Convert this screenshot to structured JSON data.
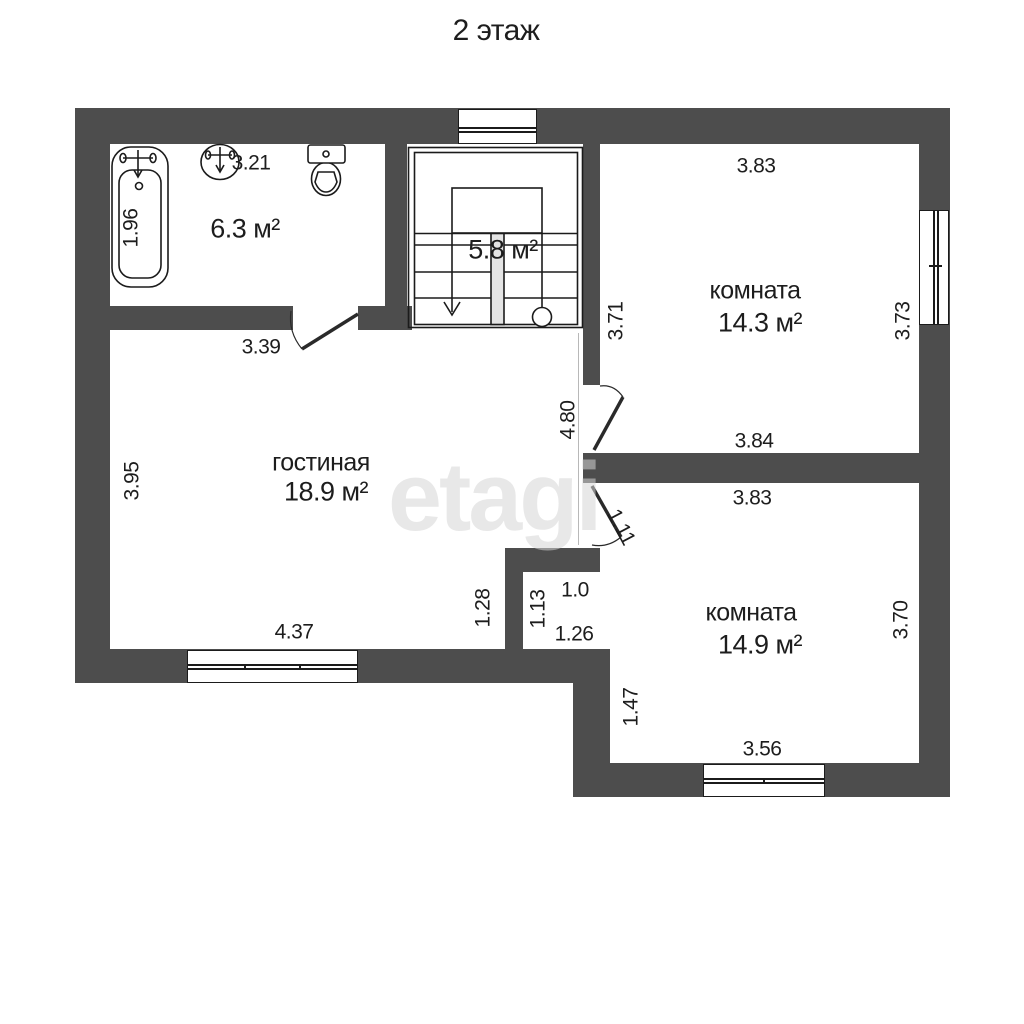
{
  "title": "2 этаж",
  "watermark": "etagi",
  "colors": {
    "wall": "#4d4d4d",
    "line": "#1b1b1b",
    "text": "#1d1d1d",
    "background": "#ffffff"
  },
  "rooms": [
    {
      "id": "bathroom",
      "name": "",
      "area": "6.3 м²",
      "fixtures": [
        "bathtub-icon",
        "sink-icon",
        "toilet-icon"
      ]
    },
    {
      "id": "staircase",
      "name": "",
      "area": "5.8 м²"
    },
    {
      "id": "room-top",
      "name": "комната",
      "area": "14.3 м²"
    },
    {
      "id": "living-room",
      "name": "гостиная",
      "area": "18.9 м²"
    },
    {
      "id": "room-bottom",
      "name": "комната",
      "area": "14.9 м²"
    }
  ],
  "labels": [
    {
      "text": "3.21",
      "x": 251,
      "y": 163,
      "rot": 0,
      "kind": "dimension"
    },
    {
      "text": "1.96",
      "x": 131,
      "y": 228,
      "rot": -90,
      "kind": "dimension"
    },
    {
      "text": "6.3 м²",
      "x": 245,
      "y": 229,
      "rot": 0,
      "kind": "room-area"
    },
    {
      "text": "5.8 м²",
      "x": 503,
      "y": 250,
      "rot": 0,
      "kind": "room-area"
    },
    {
      "text": "3.83",
      "x": 756,
      "y": 166,
      "rot": 0,
      "kind": "dimension"
    },
    {
      "text": "комната",
      "x": 755,
      "y": 291,
      "rot": 0,
      "kind": "room-name"
    },
    {
      "text": "14.3 м²",
      "x": 760,
      "y": 323,
      "rot": 0,
      "kind": "room-area"
    },
    {
      "text": "3.71",
      "x": 616,
      "y": 321,
      "rot": -90,
      "kind": "dimension"
    },
    {
      "text": "3.73",
      "x": 903,
      "y": 321,
      "rot": -90,
      "kind": "dimension"
    },
    {
      "text": "3.84",
      "x": 754,
      "y": 441,
      "rot": 0,
      "kind": "dimension"
    },
    {
      "text": "3.39",
      "x": 261,
      "y": 347,
      "rot": 0,
      "kind": "dimension"
    },
    {
      "text": "4.80",
      "x": 568,
      "y": 420,
      "rot": -90,
      "kind": "dimension"
    },
    {
      "text": "гостиная",
      "x": 321,
      "y": 463,
      "rot": 0,
      "kind": "room-name"
    },
    {
      "text": "18.9 м²",
      "x": 326,
      "y": 492,
      "rot": 0,
      "kind": "room-area"
    },
    {
      "text": "3.95",
      "x": 132,
      "y": 481,
      "rot": -90,
      "kind": "dimension"
    },
    {
      "text": "3.83",
      "x": 752,
      "y": 498,
      "rot": 0,
      "kind": "dimension"
    },
    {
      "text": "1.11",
      "x": 621,
      "y": 527,
      "rot": 62,
      "kind": "dimension"
    },
    {
      "text": "4.37",
      "x": 294,
      "y": 632,
      "rot": 0,
      "kind": "dimension"
    },
    {
      "text": "1.28",
      "x": 483,
      "y": 608,
      "rot": -90,
      "kind": "dimension"
    },
    {
      "text": "1.13",
      "x": 538,
      "y": 609,
      "rot": -90,
      "kind": "dimension"
    },
    {
      "text": "1.0",
      "x": 575,
      "y": 590,
      "rot": 0,
      "kind": "dimension"
    },
    {
      "text": "1.26",
      "x": 574,
      "y": 634,
      "rot": 0,
      "kind": "dimension"
    },
    {
      "text": "комната",
      "x": 751,
      "y": 613,
      "rot": 0,
      "kind": "room-name"
    },
    {
      "text": "14.9 м²",
      "x": 760,
      "y": 645,
      "rot": 0,
      "kind": "room-area"
    },
    {
      "text": "3.70",
      "x": 901,
      "y": 620,
      "rot": -90,
      "kind": "dimension"
    },
    {
      "text": "1.47",
      "x": 631,
      "y": 707,
      "rot": -90,
      "kind": "dimension"
    },
    {
      "text": "3.56",
      "x": 762,
      "y": 749,
      "rot": 0,
      "kind": "dimension"
    }
  ]
}
